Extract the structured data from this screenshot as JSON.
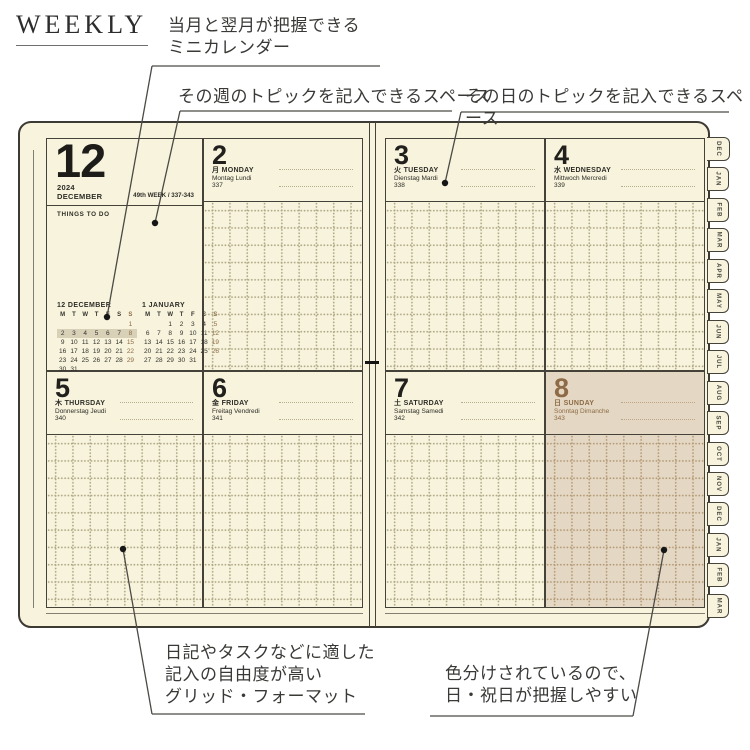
{
  "header": {
    "title": "WEEKLY"
  },
  "annotations": {
    "mini_calendar": "当月と翌月が把握できる\nミニカレンダー",
    "week_topic": "その週のトピックを記入できるスペース",
    "day_topic": "その日のトピックを記入できるスペース",
    "grid_format": "日記やタスクなどに適した\n記入の自由度が高い\nグリッド・フォーマット",
    "color_coded": "色分けされているので、\n日・祝日が把握しやすい"
  },
  "planner": {
    "month_cell": {
      "month_number": "12",
      "year": "2024",
      "month_name": "DECEMBER",
      "week_info": "49th WEEK / 337-343",
      "todo_label": "THINGS TO DO"
    },
    "mini_calendars": [
      {
        "title": "12 DECEMBER",
        "weekday_header": [
          "M",
          "T",
          "W",
          "T",
          "F",
          "S",
          "S"
        ],
        "rows": [
          [
            "",
            "",
            "",
            "",
            "",
            "",
            "1"
          ],
          [
            "2",
            "3",
            "4",
            "5",
            "6",
            "7",
            "8"
          ],
          [
            "9",
            "10",
            "11",
            "12",
            "13",
            "14",
            "15"
          ],
          [
            "16",
            "17",
            "18",
            "19",
            "20",
            "21",
            "22"
          ],
          [
            "23",
            "24",
            "25",
            "26",
            "27",
            "28",
            "29"
          ],
          [
            "30",
            "31",
            "",
            "",
            "",
            "",
            ""
          ]
        ],
        "highlighted_row": 1
      },
      {
        "title": "1 JANUARY",
        "weekday_header": [
          "M",
          "T",
          "W",
          "T",
          "F",
          "S",
          "S"
        ],
        "rows": [
          [
            "",
            "",
            "1",
            "2",
            "3",
            "4",
            "5"
          ],
          [
            "6",
            "7",
            "8",
            "9",
            "10",
            "11",
            "12"
          ],
          [
            "13",
            "14",
            "15",
            "16",
            "17",
            "18",
            "19"
          ],
          [
            "20",
            "21",
            "22",
            "23",
            "24",
            "25",
            "26"
          ],
          [
            "27",
            "28",
            "29",
            "30",
            "31",
            "",
            ""
          ]
        ]
      }
    ],
    "days": [
      {
        "date": "2",
        "kanji": "月",
        "name": "MONDAY",
        "translations": "Montag Lundi",
        "day_of_year": "337",
        "is_sunday": false
      },
      {
        "date": "3",
        "kanji": "火",
        "name": "TUESDAY",
        "translations": "Dienstag Mardi",
        "day_of_year": "338",
        "is_sunday": false
      },
      {
        "date": "4",
        "kanji": "水",
        "name": "WEDNESDAY",
        "translations": "Mittwoch Mercredi",
        "day_of_year": "339",
        "is_sunday": false
      },
      {
        "date": "5",
        "kanji": "木",
        "name": "THURSDAY",
        "translations": "Donnerstag Jeudi",
        "day_of_year": "340",
        "is_sunday": false
      },
      {
        "date": "6",
        "kanji": "金",
        "name": "FRIDAY",
        "translations": "Freitag Vendredi",
        "day_of_year": "341",
        "is_sunday": false
      },
      {
        "date": "7",
        "kanji": "土",
        "name": "SATURDAY",
        "translations": "Samstag Samedi",
        "day_of_year": "342",
        "is_sunday": false
      },
      {
        "date": "8",
        "kanji": "日",
        "name": "SUNDAY",
        "translations": "Sonntag Dimanche",
        "day_of_year": "343",
        "is_sunday": true
      }
    ],
    "month_tabs": [
      "DEC",
      "JAN",
      "FEB",
      "MAR",
      "APR",
      "MAY",
      "JUN",
      "JUL",
      "AUG",
      "SEP",
      "OCT",
      "NOV",
      "DEC",
      "JAN",
      "FEB",
      "MAR"
    ]
  },
  "colors": {
    "page_cream": "#f7f3dc",
    "sunday_tan": "#e4d8c4",
    "sunday_brown": "#8e6b46",
    "grid_dot": "#b0a987",
    "border_dark": "#45423a",
    "highlight_band": "#d8d1b8"
  }
}
